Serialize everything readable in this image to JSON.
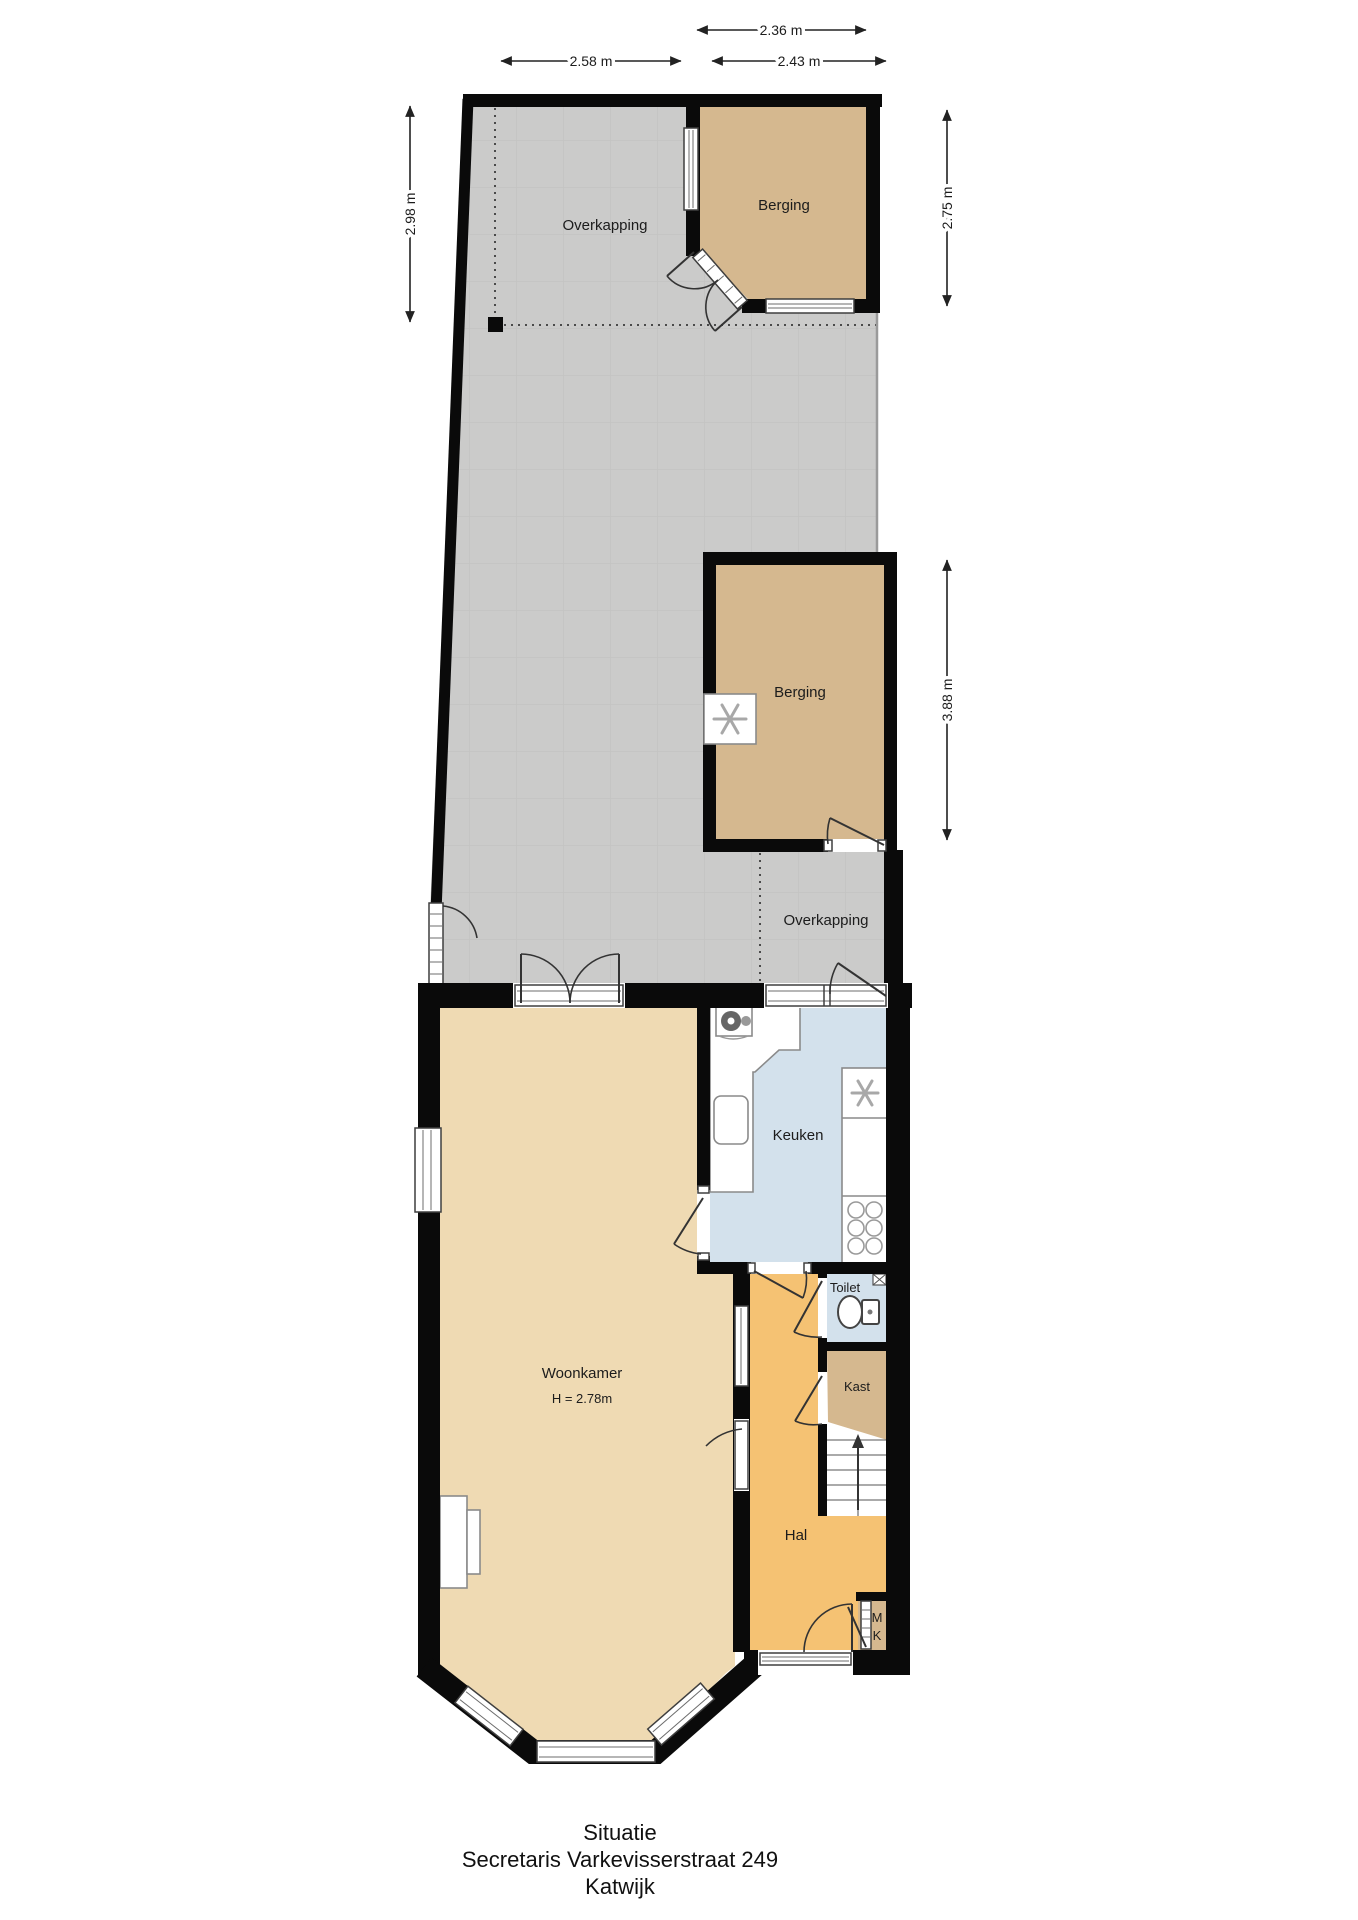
{
  "plan": {
    "rooms": {
      "overkapping_top": "Overkapping",
      "berging_top": "Berging",
      "berging_mid": "Berging",
      "overkapping_lower": "Overkapping",
      "keuken": "Keuken",
      "woonkamer": "Woonkamer",
      "woonkamer_height": "H = 2.78m",
      "toilet": "Toilet",
      "kast": "Kast",
      "hal": "Hal",
      "meterkast_line1": "M",
      "meterkast_line2": "K"
    },
    "dimensions": {
      "garden_left_width": "2.58 m",
      "berging_top_width_outer": "2.36 m",
      "berging_top_width": "2.43 m",
      "garden_left_height": "2.98 m",
      "berging_top_height": "2.75 m",
      "berging_mid_height": "3.88 m"
    },
    "title": {
      "caption": "Situatie",
      "address": "Secretaris Varkevisserstraat 249",
      "city": "Katwijk"
    },
    "colors": {
      "wall": "#0a0a0a",
      "garden_tiles": "#cbcbca",
      "shed_floor": "#d5b88f",
      "living_floor": "#efdab3",
      "hall_floor": "#f5c273",
      "kitchen_toilet_floor": "#d3e1ec",
      "window_frame": "#3f3f3f"
    }
  }
}
